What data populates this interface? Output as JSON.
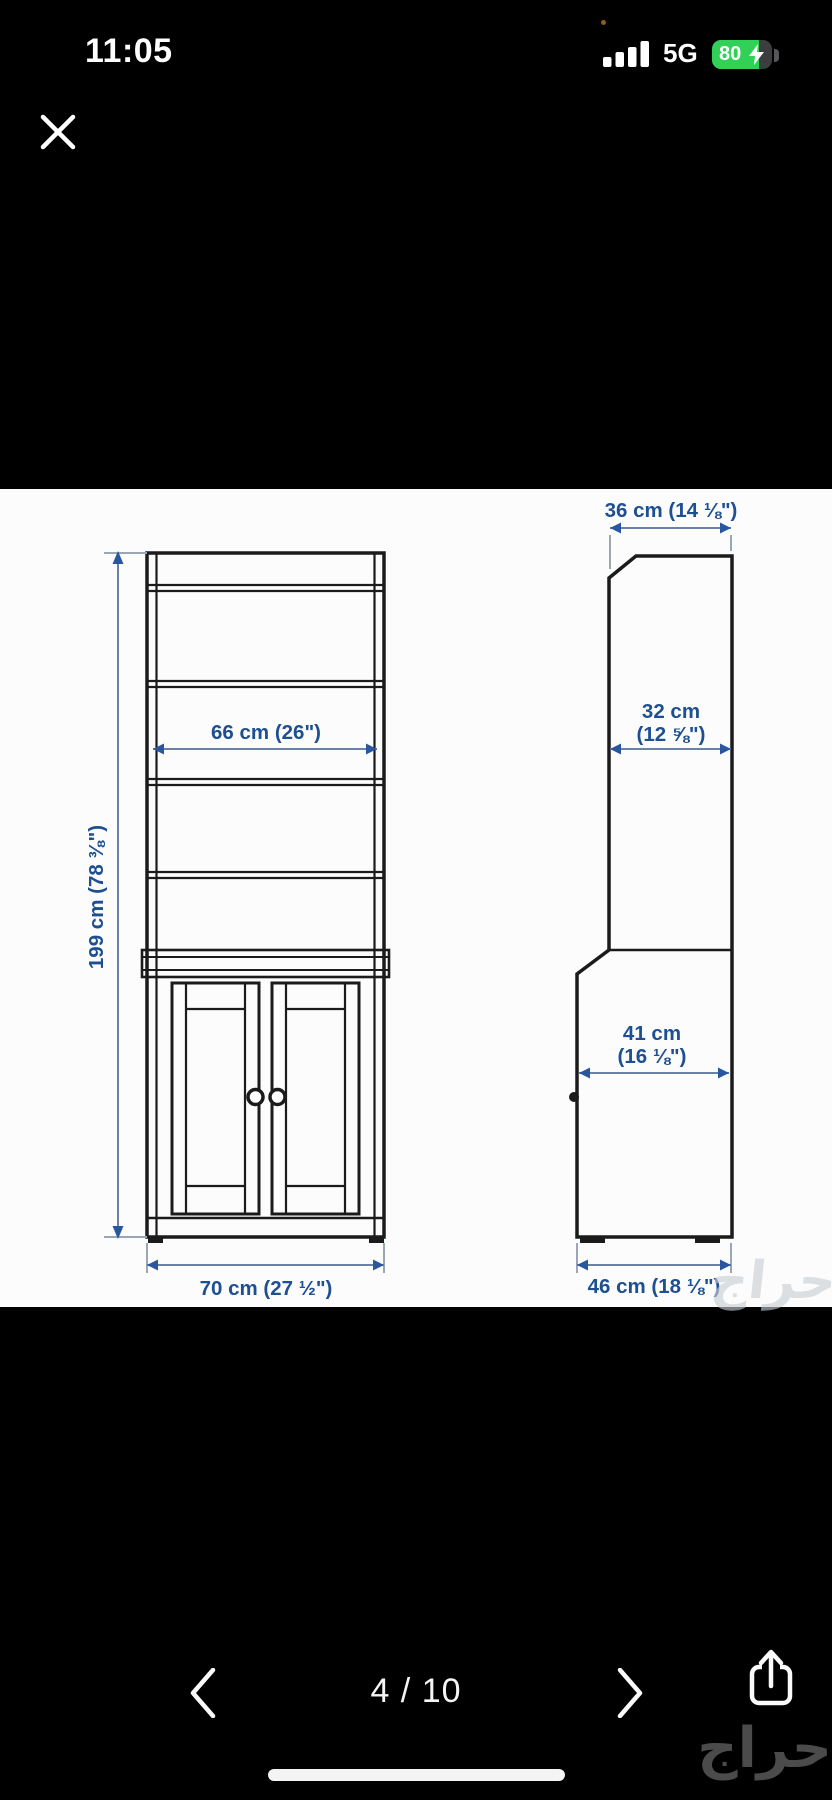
{
  "status_bar": {
    "time": "11:05",
    "network": "5G",
    "battery_percent": "80"
  },
  "viewer": {
    "pager_text": "4 / 10",
    "icons": {
      "close_icon": "✕",
      "prev_icon": "‹",
      "next_icon": "›",
      "share_icon": "box-with-up-arrow"
    }
  },
  "diagram": {
    "labels": {
      "height": "199 cm (78 ⅜\")",
      "shelf_width": "66 cm (26\")",
      "base_width": "70 cm (27 ½\")",
      "top_depth": "36 cm (14 ⅛\")",
      "upper_depth_1": "32 cm",
      "upper_depth_2": "(12 ⅝\")",
      "lower_depth_1": "41 cm",
      "lower_depth_2": "(16 ⅛\")",
      "base_depth": "46 cm (18 ⅛\")"
    },
    "colors": {
      "label_blue": "#1d4f91",
      "dim_line": "#6b82a6",
      "arrow_blue": "#2a56a0",
      "stroke_black": "#1b1b1b"
    }
  },
  "watermark": {
    "ghost": "حراج",
    "logo": "حراج"
  }
}
